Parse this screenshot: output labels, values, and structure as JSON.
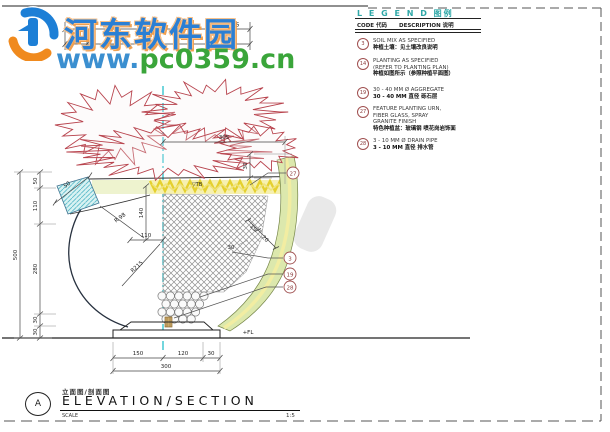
{
  "watermark": {
    "site_name": "河东软件园",
    "url_www": "www.",
    "url_rest": "pc0359.cn"
  },
  "legend": {
    "title": "L E G E N D 图例",
    "col_code": "CODE 代码",
    "col_desc": "DESCRIPTION 说明",
    "items": [
      {
        "code": "3",
        "lines": [
          "SOIL MIX AS SPECIFIED",
          "种植土壤：见土壤改良说明"
        ]
      },
      {
        "code": "14",
        "lines": [
          "PLANTING AS SPECIFIED",
          "(REFER TO PLANTING PLAN)",
          "种植如图所示（参照种植平面图）"
        ]
      },
      {
        "code": "19",
        "lines": [
          "30 - 40 MM Ø AGGREGATE",
          "30 - 40 MM 直径 砾石层"
        ]
      },
      {
        "code": "27",
        "lines": [
          "FEATURE PLANTING URN,",
          "FIBER GLASS, SPRAY",
          "GRANITE FINISH",
          "特色种植盆：玻璃钢 喷花岗岩饰面"
        ]
      },
      {
        "code": "28",
        "lines": [
          "3 - 10 MM Ø DRAIN PIPE",
          "3 - 10 MM 直径 排水管"
        ]
      }
    ]
  },
  "drawing": {
    "dims": {
      "top_seg1": "520",
      "top_seg2": "75",
      "top_seg3": "70",
      "spread": "305",
      "left_total": "500",
      "left_seg1": "50",
      "left_seg2": "110",
      "left_seg3": "280",
      "left_seg4": "30",
      "left_seg5": "30",
      "rim_drop": "30",
      "lip_width": "50",
      "soil_depth": "140",
      "soil_width": "110",
      "radius_inner": "R 98",
      "radius_outer": "R215",
      "wall_t1": "15",
      "wall_t2": "20",
      "wall_t3": "30",
      "base_seg1": "150",
      "base_seg2": "120",
      "base_seg3": "30",
      "base_total": "300"
    },
    "levels": {
      "top_of_soil": "▽TB",
      "floor_level": "+FL"
    },
    "callouts": [
      "27",
      "3",
      "19",
      "28"
    ]
  },
  "titleblock": {
    "detail_letter": "A",
    "title_zh": "立面图/剖面图",
    "title_en": "ELEVATION/SECTION",
    "scale_label": "SCALE",
    "scale_value": "1:5"
  },
  "colors": {
    "accent_teal": "#2fa8a8",
    "foliage_red": "#b8444e",
    "urn_wall_green": "#dce8ad",
    "soil_yellow": "#e5d02f",
    "centerline_cyan": "#45c8d2",
    "watermark_blue": "#2b7fd4",
    "watermark_green": "#3aa53a",
    "watermark_orange": "#f08a1e",
    "callout_maroon": "#a05050"
  }
}
